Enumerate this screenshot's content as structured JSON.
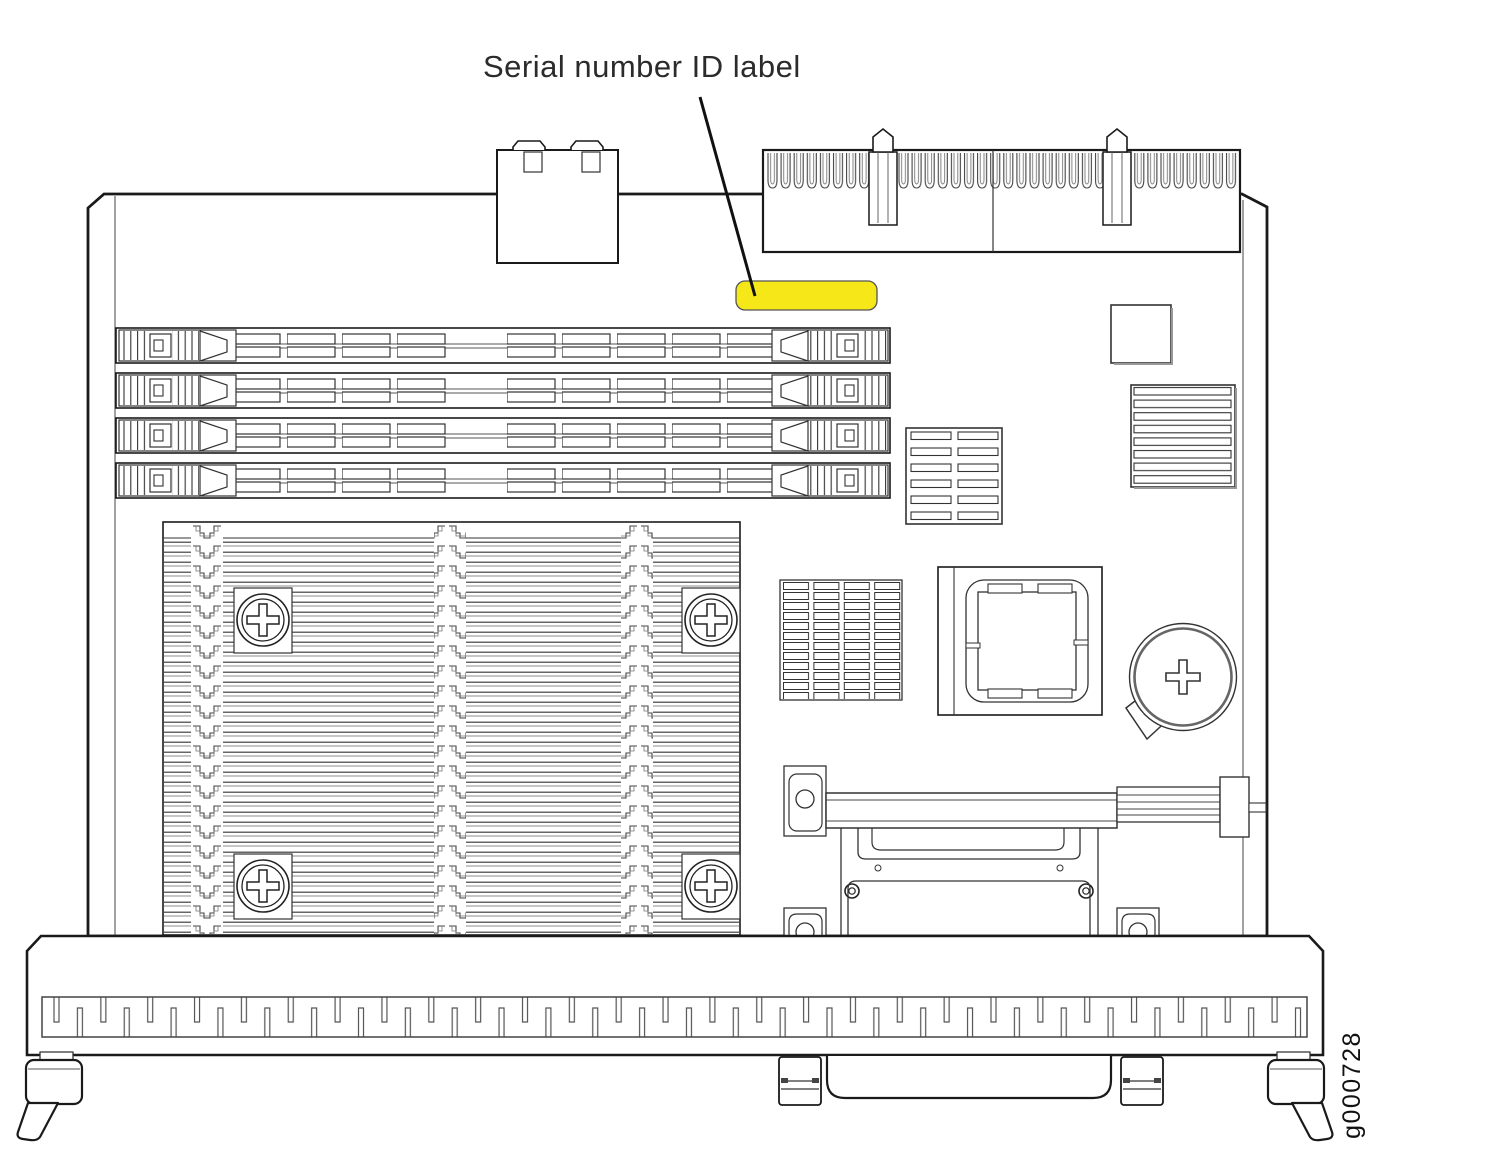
{
  "figure": {
    "title": "Serial number ID label",
    "figure_id": "g000728"
  },
  "colors": {
    "highlight_yellow": "#F6E718",
    "line_dark": "#1a1a1a"
  }
}
